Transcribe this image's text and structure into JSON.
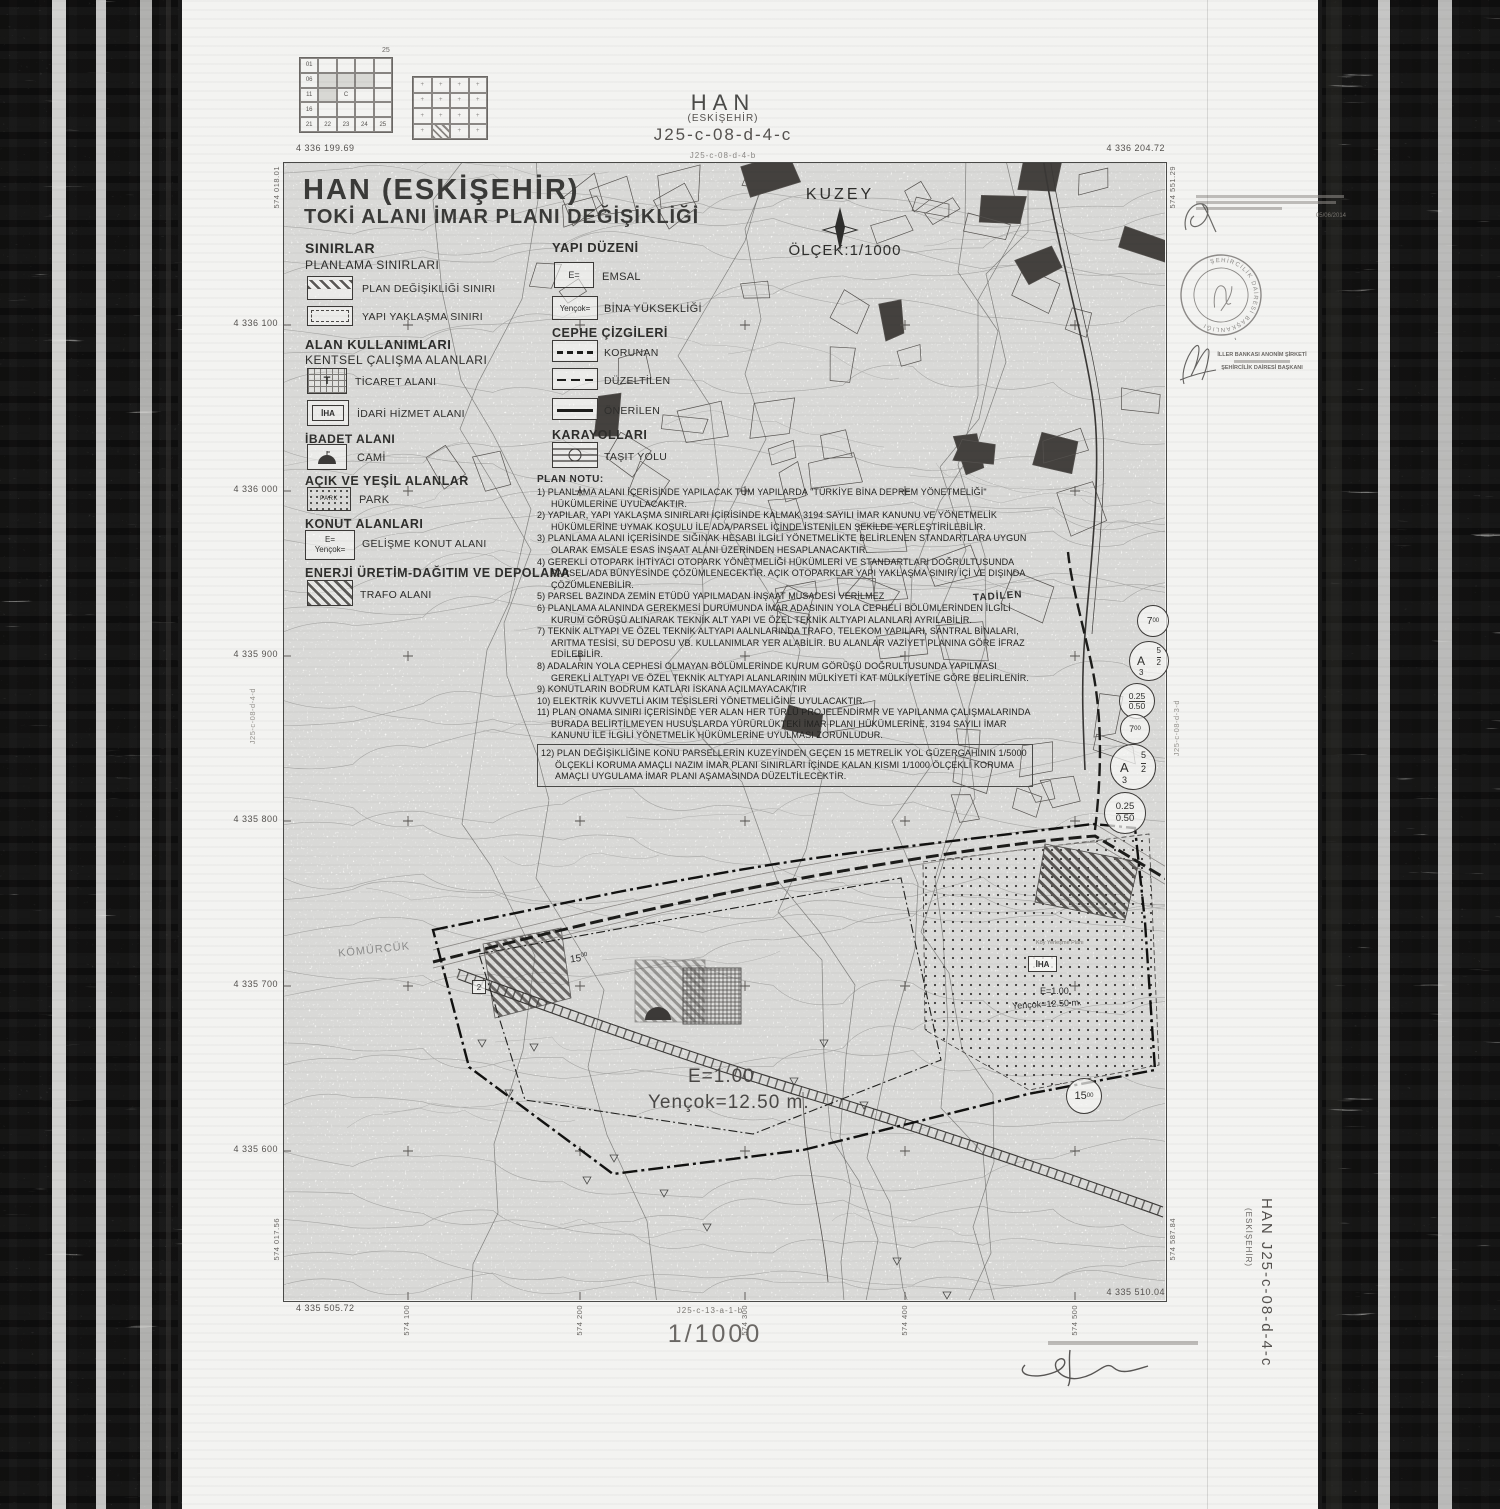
{
  "header": {
    "title": "HAN",
    "subtitle": "(ESKİŞEHİR)",
    "sheet_code": "J25-c-08-d-4-c",
    "adjacent_sheet_top": "J25-c-08-d-4-b"
  },
  "index_map": {
    "corner_label": "25",
    "left_grid_labels": [
      "01",
      "06",
      "11",
      "16",
      "21",
      "22",
      "23",
      "24",
      "25"
    ],
    "center_label": "C"
  },
  "title_block": {
    "line1": "HAN (ESKİŞEHİR)",
    "line2": "TOKİ ALANI İMAR PLANI DEĞİŞİKLİĞİ"
  },
  "compass": {
    "label": "KUZEY",
    "scale": "ÖLÇEK:1/1000"
  },
  "legend_left": {
    "h1": "SINIRLAR",
    "h2": "PLANLAMA SINIRLARI",
    "plan_degisikligi": "PLAN DEĞİŞİKLİĞİ SINIRI",
    "yapi_yaklasma": "YAPI YAKLAŞMA SINIRI",
    "h3": "ALAN KULLANIMLARI",
    "h4": "KENTSEL ÇALIŞMA ALANLARI",
    "ticaret": "TİCARET ALANI",
    "ticaret_sym": "T",
    "idari": "İDARİ HİZMET ALANI",
    "idari_sym": "İHA",
    "h5": "İBADET ALANI",
    "cami": "CAMİ",
    "h6": "AÇIK VE YEŞİL ALANLAR",
    "park": "PARK",
    "park_sym": "PARK",
    "h7": "KONUT ALANLARI",
    "gelisme": "GELİŞME KONUT ALANI",
    "gelisme_sym1": "E=",
    "gelisme_sym2": "Yençok=",
    "h8": "ENERJİ ÜRETİM-DAĞITIM VE DEPOLAMA",
    "trafo": "TRAFO ALANI"
  },
  "legend_right": {
    "h1": "YAPI DÜZENİ",
    "emsal": "EMSAL",
    "emsal_sym": "E=",
    "bina": "BİNA YÜKSEKLİĞİ",
    "bina_sym": "Yençok=",
    "h2": "CEPHE ÇİZGİLERİ",
    "korunan": "KORUNAN",
    "duzeltilen": "DÜZELTİLEN",
    "onerilen": "ÖNERİLEN",
    "h3": "KARAYOLLARI",
    "tasit": "TAŞIT YOLU"
  },
  "plan_notes": {
    "title": "PLAN NOTU:",
    "items": [
      "1) PLANLAMA ALANI İÇERİSİNDE YAPILACAK TÜM YAPILARDA \"TÜRKİYE BİNA DEPREM YÖNETMELİĞİ\" HÜKÜMLERİNE UYULACAKTIR.",
      "2) YAPILAR, YAPI YAKLAŞMA SINIRLARI İÇİRİSİNDE KALMAK 3194 SAYILI İMAR KANUNU VE YÖNETMELİK HÜKÜMLERİNE UYMAK KOŞULU İLE ADA/PARSEL İÇİNDE İSTENİLEN ŞEKİLDE YERLEŞTİRİLEBİLİR.",
      "3) PLANLAMA ALANI İÇERİSİNDE SIĞINAK HESABI İLGİLİ YÖNETMELİKTE BELİRLENEN STANDARTLARA UYGUN OLARAK EMSALE ESAS İNŞAAT ALANI ÜZERİNDEN HESAPLANACAKTIR.",
      "4) GEREKLİ OTOPARK İHTİYACI OTOPARK YÖNETMELİĞİ HÜKÜMLERİ VE STANDARTLARI DOĞRULTUSUNDA PARSEL/ADA BÜNYESİNDE ÇÖZÜMLENECEKTİR. AÇIK OTOPARKLAR YAPI YAKLAŞMA SINIRI İÇİ VE DIŞINDA ÇÖZÜMLENEBİLİR.",
      "5) PARSEL BAZINDA ZEMİN ETÜDÜ YAPILMADAN İNŞAAT MÜSADESİ VERİLMEZ",
      "6) PLANLAMA ALANINDA GEREKMESİ DURUMUNDA İMAR ADASININ YOLA CEPHELİ BÖLÜMLERİNDEN İLGİLİ KURUM GÖRÜŞÜ ALINARAK TEKNİK ALT YAPI VE ÖZEL TEKNİK ALTYAPI ALANLARI AYRILABİLİR.",
      "7) TEKNİK ALTYAPI VE ÖZEL TEKNİK ALTYAPI AALNLARINDA TRAFO, TELEKOM YAPILARI, SANTRAL BİNALARI, ARITMA TESİSİ, SU DEPOSU VB. KULLANIMLAR YER ALABİLİR. BU ALANLAR VAZİYET PLANINA GÖRE İFRAZ EDİLEBİLİR.",
      "8) ADALARIN YOLA CEPHESİ OLMAYAN BÖLÜMLERİNDE KURUM GÖRÜŞÜ DOĞRULTUSUNDA YAPILMASI GEREKLİ ALTYAPI VE ÖZEL TEKNİK ALTYAPI ALANLARININ MÜLKİYETİ KAT MÜLKİYETİNE GÖRE BELİRLENİR.",
      "9) KONUTLARIN BODRUM KATLARI İSKANA AÇILMAYACAKTIR",
      "10) ELEKTRİK KUVVETLİ AKIM TESİSLERİ YÖNETMELİĞİNE UYULACAKTIR.",
      "11) PLAN ONAMA SINIRI İÇERİSİNDE YER ALAN HER TÜRLÜ PROJELENDİRMR VE YAPILANMA ÇALIŞMALARINDA BURADA BELİRTİLMEYEN HUSUSLARDA YÜRÜRLÜKTEKİ İMAR PLANI HÜKÜMLERİNE, 3194 SAYILI İMAR KANUNU İLE İLGİLİ YÖNETMELİK HÜKÜMLERİNE UYULMASI ZORUNLUDUR.",
      "12) PLAN DEĞİŞİKLİĞİNE KONU PARSELLERİN KUZEYİNDEN GEÇEN 15 METRELİK YOL GÜZERGAHININ 1/5000 ÖLÇEKLİ KORUMA AMAÇLI NAZIM İMAR PLANI SINIRLARI İÇİNDE KALAN KISMI 1/1000 ÖLÇEKLİ KORUMA AMAÇLI UYGULAMA İMAR PLANI AŞAMASINDA DÜZELTİLECEKTİR."
    ]
  },
  "map_labels": {
    "tadilen": "TADİLEN",
    "komurcuk": "KÖMÜRCÜK",
    "iha": "İHA",
    "iha_e": "E=1.00",
    "iha_y": "Yençok=12.50 m.",
    "koy": "Köy Yerleşme Planı",
    "emsal_big_1": "E=1.00",
    "emsal_big_2": "Yençok=12.50 m.",
    "w15_int": "15",
    "w15_dec": "00",
    "w7_int": "7",
    "w7_dec": "00",
    "zone": {
      "letter": "A",
      "n1": "5",
      "n2": "2",
      "n3": "3"
    },
    "ratio_top": "0.25",
    "ratio_bottom": "0.50",
    "parcel2": "2"
  },
  "coords": {
    "tl_e": "4 336 199.69",
    "tl_n": "574 018.01",
    "tr_e": "4 336 204.72",
    "tr_n": "574 551.29",
    "bl_e": "4 335 505.72",
    "bl_n": "574 017.56",
    "br_e": "4 335 510.04",
    "br_n": "574 587.84",
    "left": [
      "4 336 100",
      "4 336 000",
      "4 335 900",
      "4 335 800",
      "4 335 700",
      "4 335 600"
    ],
    "bottom": [
      "574 100",
      "574 200",
      "574 300",
      "574 400",
      "574 500"
    ]
  },
  "margins": {
    "left_sheet": "J25-c-08-d-4-d",
    "right_sheet": "J25-c-08-d-3-d",
    "bottom_sheet": "J25-c-13-a-1-b",
    "right_title": "HAN  J25-c-08-d-4-c",
    "right_subtitle": "(ESKİŞEHİR)"
  },
  "footer": {
    "scale": "1/1000"
  },
  "approval": {
    "date": "05/06/2014",
    "stamp_text": "ŞEHİRCİLİK DAİRESİ BAŞKANLIĞI",
    "sig_line1": "İLLER BANKASI ANONİM ŞİRKETİ",
    "sig_line2": "ŞEHİRCİLİK DAİRESİ BAŞKANI"
  }
}
